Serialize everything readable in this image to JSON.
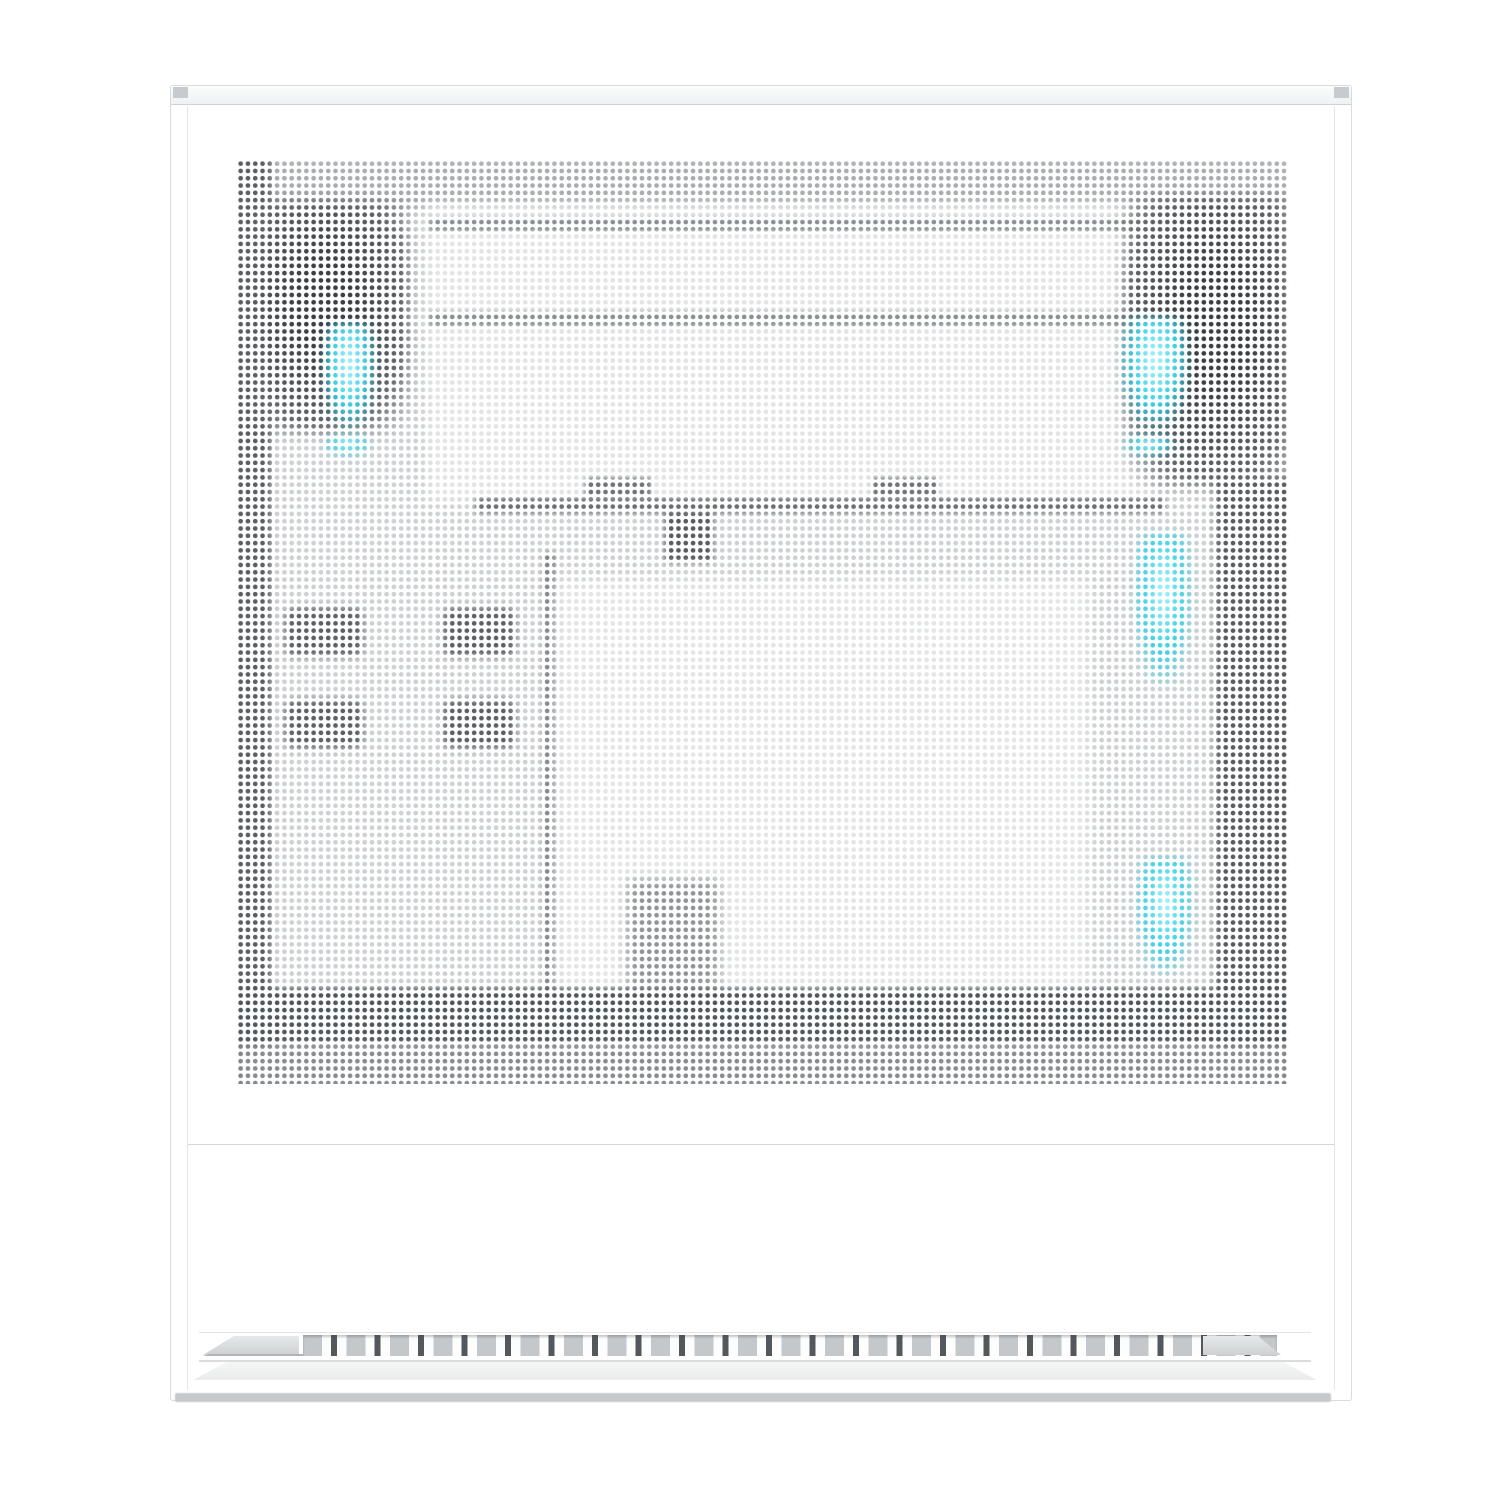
{
  "scene": {
    "subject": "white PC tower case, perforated side mesh panel",
    "description": "Product photo of a white PC case seen from the side. The panel is fully perforated with a fine grid of round holes; dark silhouettes of front fans, radiator frame, GPU bar and cable connectors show through the mesh, with cyan RGB fan light glowing at the top-left, top-right and along the right edge. A slotted air vent strip with alternating wide and narrow slots runs along the bottom, above a soft ground shadow."
  },
  "colors": {
    "page_bg": "#ffffff",
    "case_white": "#ffffff",
    "edge_line": "#d9dbdd",
    "seam_line": "#cfd2d4",
    "gap_line": "#e3e5e6",
    "tab_gray": "#c8cbcd",
    "mesh_base": "#ced1d3",
    "mesh_white": "#ffffff",
    "sil_dark": "#43484d",
    "sil_col": "#5a5f64",
    "sil_mid": "#84898d",
    "sil_light": "#e2e4e5",
    "glow_core": "#b5f6fb",
    "glow_cyan": "#36cfe6",
    "vent_light": "#c5c8ca",
    "vent_dark": "#54585b",
    "ramp_gray": "#d9dcdd",
    "shelf_gray": "#f1f2f3",
    "shadow_gray": "#c4c6c7"
  },
  "mesh": {
    "dot_pitch_px": 7.31,
    "dot_diameter_px": 4.3,
    "columns": 144,
    "rows": 126
  },
  "lighting": {
    "glow_count": 6,
    "glow_color": "#36cfe6",
    "regions": [
      "top-left",
      "top-left-small",
      "top-right",
      "top-right-small",
      "right-upper",
      "right-lower"
    ]
  },
  "vents": {
    "pattern": "alternating wide light slots and narrow dark slots",
    "wide_slot_count": 24,
    "narrow_slot_count": 24
  }
}
